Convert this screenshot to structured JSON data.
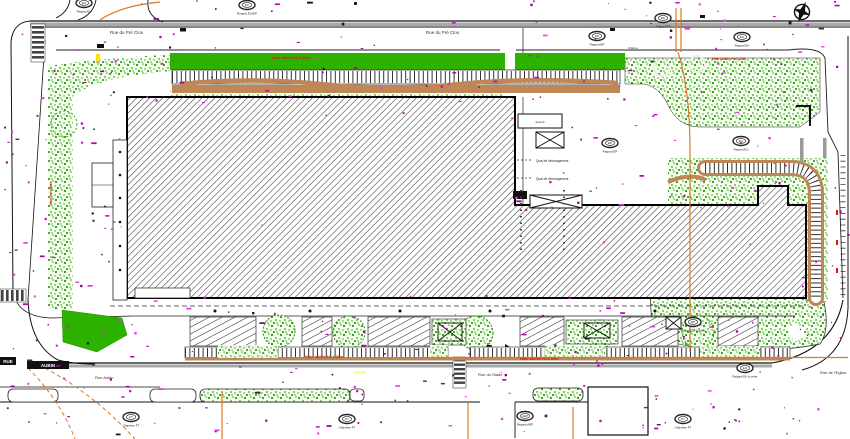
{
  "colors": {
    "lawn_green": "#2db200",
    "stipple_green": "#1fa000",
    "hedge_brown": "#bf8656",
    "magenta_points": "#c400c4",
    "utility_orange": "#e07820",
    "road_gray": "#a8a8a8",
    "hatch_gray": "#3b3b3b",
    "annotation_red": "#d42000"
  },
  "streets": {
    "top_left": "Rue du Pré Clos",
    "top_right": "Rue du Pré Clos",
    "bottom_left": "Rue Aubin",
    "bottom_center": "Rue du Stade",
    "bottom_right": "Rue de l'Eglise",
    "name_plate_1": "RUE",
    "name_plate_2": "AUBIN"
  },
  "annotations": {
    "hedge_top": "Haie taillée H=1.80m",
    "hedge_lawn": "Haie taillée H=1.80m",
    "hedge_bottom_1": "Haie taillée H=1.80m",
    "hedge_bottom_2": "Haie taillée H=1.80m",
    "hedge_left_vertical": "Haie existante",
    "dock_label_1": "Quai de déchargement",
    "dock_label_2": "Quai de déchargement",
    "canopy_label": "auvent",
    "fence_label": "Clôture"
  },
  "manholes": [
    {
      "inner": "EU",
      "label": "Regard EU"
    },
    {
      "inner": "EU",
      "label": "Regard EU/EP"
    },
    {
      "inner": "EP",
      "label": "Regard EP"
    },
    {
      "inner": "EP",
      "label": "Regard EP"
    },
    {
      "inner": "EU",
      "label": "Regard EU"
    },
    {
      "inner": "EP",
      "label": "Regard EP"
    },
    {
      "inner": "EU",
      "label": "Regard EU"
    },
    {
      "inner": "FT",
      "label": "Chambre FT"
    },
    {
      "inner": "FT",
      "label": "Chambre FT"
    },
    {
      "inner": "AEP",
      "label": "Regard AEP"
    },
    {
      "inner": "EP",
      "label": "Regard EP à créer"
    },
    {
      "inner": "EU",
      "label": "Regard EU à créer"
    },
    {
      "inner": "FT",
      "label": "Chambre FT"
    }
  ],
  "scatter": {
    "magenta": {
      "seed": 11,
      "count": 310,
      "size": 1.5,
      "colors": [
        "#c400c4",
        "#e23ae2",
        "#9b009b"
      ]
    },
    "black": {
      "seed": 5,
      "count": 58,
      "size": 1.8,
      "road": true,
      "colors": [
        "#161616",
        "#333333"
      ]
    }
  }
}
